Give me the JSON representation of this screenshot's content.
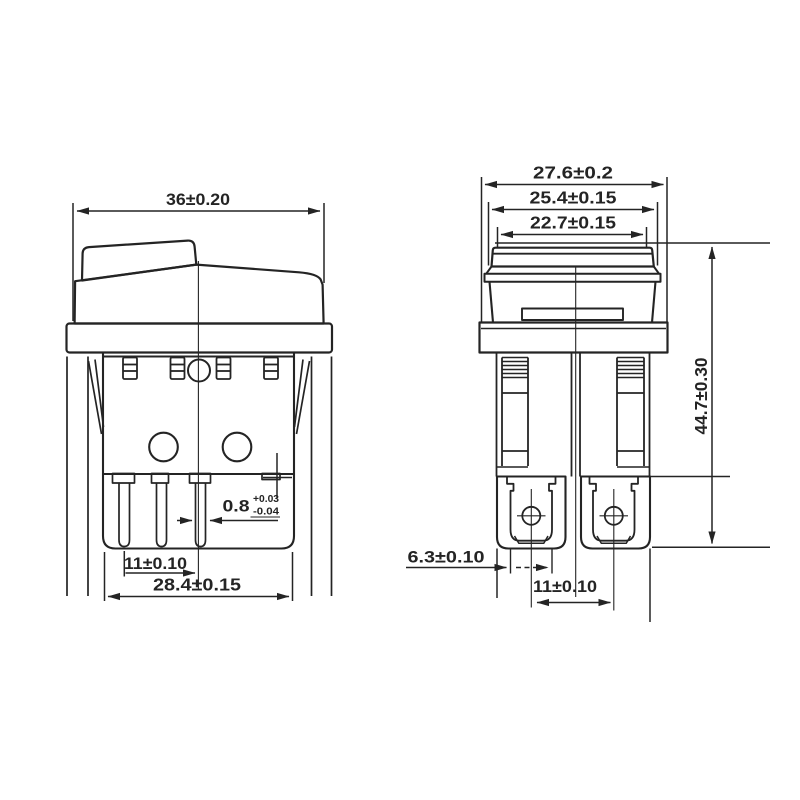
{
  "front": {
    "dim_width": "36±0.20",
    "pin_thickness": "0.8",
    "pin_thickness_upper_tol": "+0.03",
    "pin_thickness_lower_tol": "-0.04",
    "dim_pin_spacing": "11±0.10",
    "dim_body_width": "28.4±0.15"
  },
  "side": {
    "dim_flange_width": "27.6±0.2",
    "dim_bezel_width": "25.4±0.15",
    "dim_rocker_width": "22.7±0.15",
    "dim_overall_height": "44.7±0.30",
    "dim_terminal_width": "6.3±0.10",
    "dim_terminal_spacing": "11±0.10"
  },
  "colors": {
    "background": "#ffffff",
    "line": "#242424"
  }
}
